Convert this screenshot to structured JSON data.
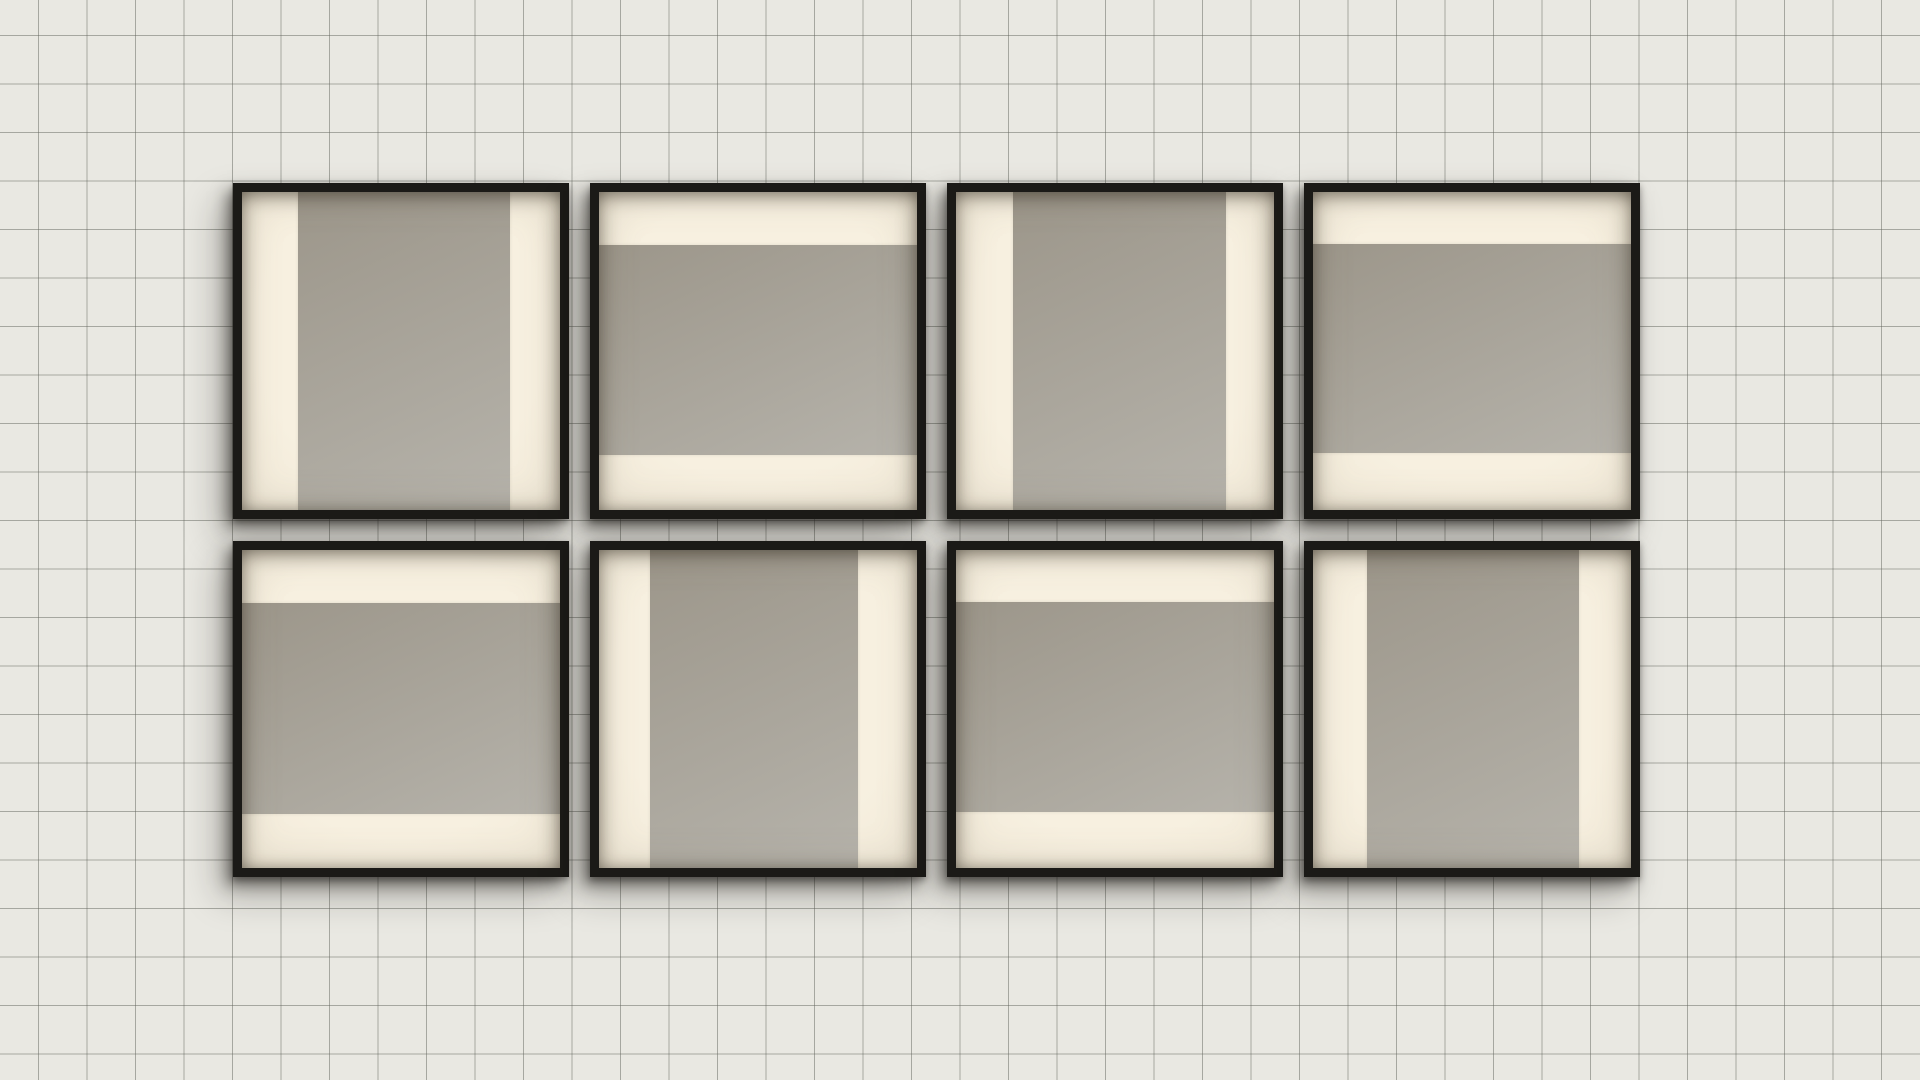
{
  "scene": {
    "description": "gallery wall with eight square black frames in two rows of four on grid paper; each frame holds a cream mat with a single warm-gray bar, alternating vertical and horizontal in a checkerboard pattern",
    "theme": {
      "paper_color": "#e9e8e2",
      "grid_line_color": "rgba(100,102,94,0.5)",
      "grid_cell_px": 48.5,
      "grid_offset_x_px": 38,
      "grid_offset_y_px": 35,
      "frame_border_color": "#1b1a17",
      "frame_border_px": 9,
      "frame_size_px": 336,
      "gap_x_px": 21,
      "gap_y_px": 22,
      "origin_x_px": 233,
      "origin_y_px": 183,
      "mat_center_color": "#f7f0e0",
      "mat_edge_color": "#e5dcc9",
      "bar_dark_color": "#9c968a",
      "bar_light_color": "#b6b3ab",
      "shadow_color": "rgba(25,23,19,0.5)"
    },
    "frames": [
      {
        "id": 1,
        "row": 0,
        "col": 0,
        "orientation": "vertical",
        "start_pct": 17.5,
        "size_pct": 66.9
      },
      {
        "id": 2,
        "row": 0,
        "col": 1,
        "orientation": "horizontal",
        "start_pct": 16.6,
        "size_pct": 66.2
      },
      {
        "id": 3,
        "row": 0,
        "col": 2,
        "orientation": "vertical",
        "start_pct": 18.0,
        "size_pct": 67.0
      },
      {
        "id": 4,
        "row": 0,
        "col": 3,
        "orientation": "horizontal",
        "start_pct": 16.3,
        "size_pct": 65.7
      },
      {
        "id": 5,
        "row": 1,
        "col": 0,
        "orientation": "horizontal",
        "start_pct": 16.6,
        "size_pct": 66.4
      },
      {
        "id": 6,
        "row": 1,
        "col": 1,
        "orientation": "vertical",
        "start_pct": 16.0,
        "size_pct": 65.5
      },
      {
        "id": 7,
        "row": 1,
        "col": 2,
        "orientation": "horizontal",
        "start_pct": 16.5,
        "size_pct": 66.0
      },
      {
        "id": 8,
        "row": 1,
        "col": 3,
        "orientation": "vertical",
        "start_pct": 17.0,
        "size_pct": 66.5
      }
    ]
  }
}
